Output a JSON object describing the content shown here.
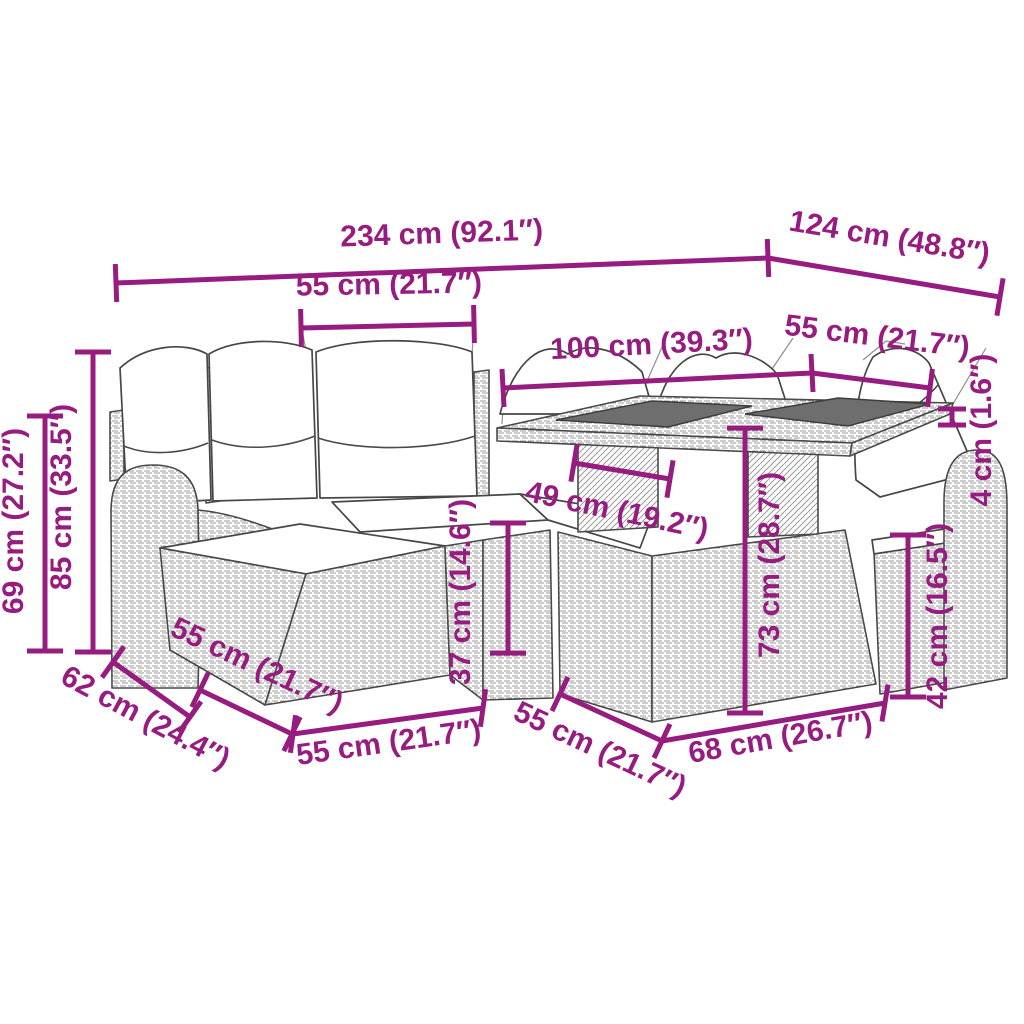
{
  "diagram": {
    "type": "product-dimension-diagram",
    "subject": "garden rattan lounge set with table",
    "background": "#ffffff"
  },
  "colors": {
    "dimension_annotation": "#971C7F",
    "furniture_outline": "#4a4a4a",
    "glass_top": "#6e6e6e",
    "cushion_fill": "#ffffff"
  },
  "dims": {
    "total_width": {
      "label": "234 cm (92.1″)"
    },
    "total_depth": {
      "label": "124 cm (48.8″)"
    },
    "seat_width": {
      "label": "55 cm (21.7″)"
    },
    "table_length": {
      "label": "100 cm (39.3″)"
    },
    "table_width": {
      "label": "55 cm (21.7″)"
    },
    "glass_thickness": {
      "label": "4 cm (1.6″)"
    },
    "back_height": {
      "label": "85 cm (33.5″)"
    },
    "arm_height": {
      "label": "69 cm (27.2″)"
    },
    "seat_height": {
      "label": "37 cm (14.6″)"
    },
    "seat_depth": {
      "label": "49 cm (19.2″)"
    },
    "table_height": {
      "label": "73 cm (28.7″)"
    },
    "chair_seat_height": {
      "label": "42 cm (16.5″)"
    },
    "arm_depth": {
      "label": "62 cm (24.4″)"
    },
    "ottoman_depth": {
      "label": "55 cm (21.7″)"
    },
    "ottoman_width": {
      "label": "55 cm (21.7″)"
    },
    "table_base_depth": {
      "label": "55 cm (21.7″)"
    },
    "table_base_width": {
      "label": "68 cm (26.7″)"
    }
  }
}
